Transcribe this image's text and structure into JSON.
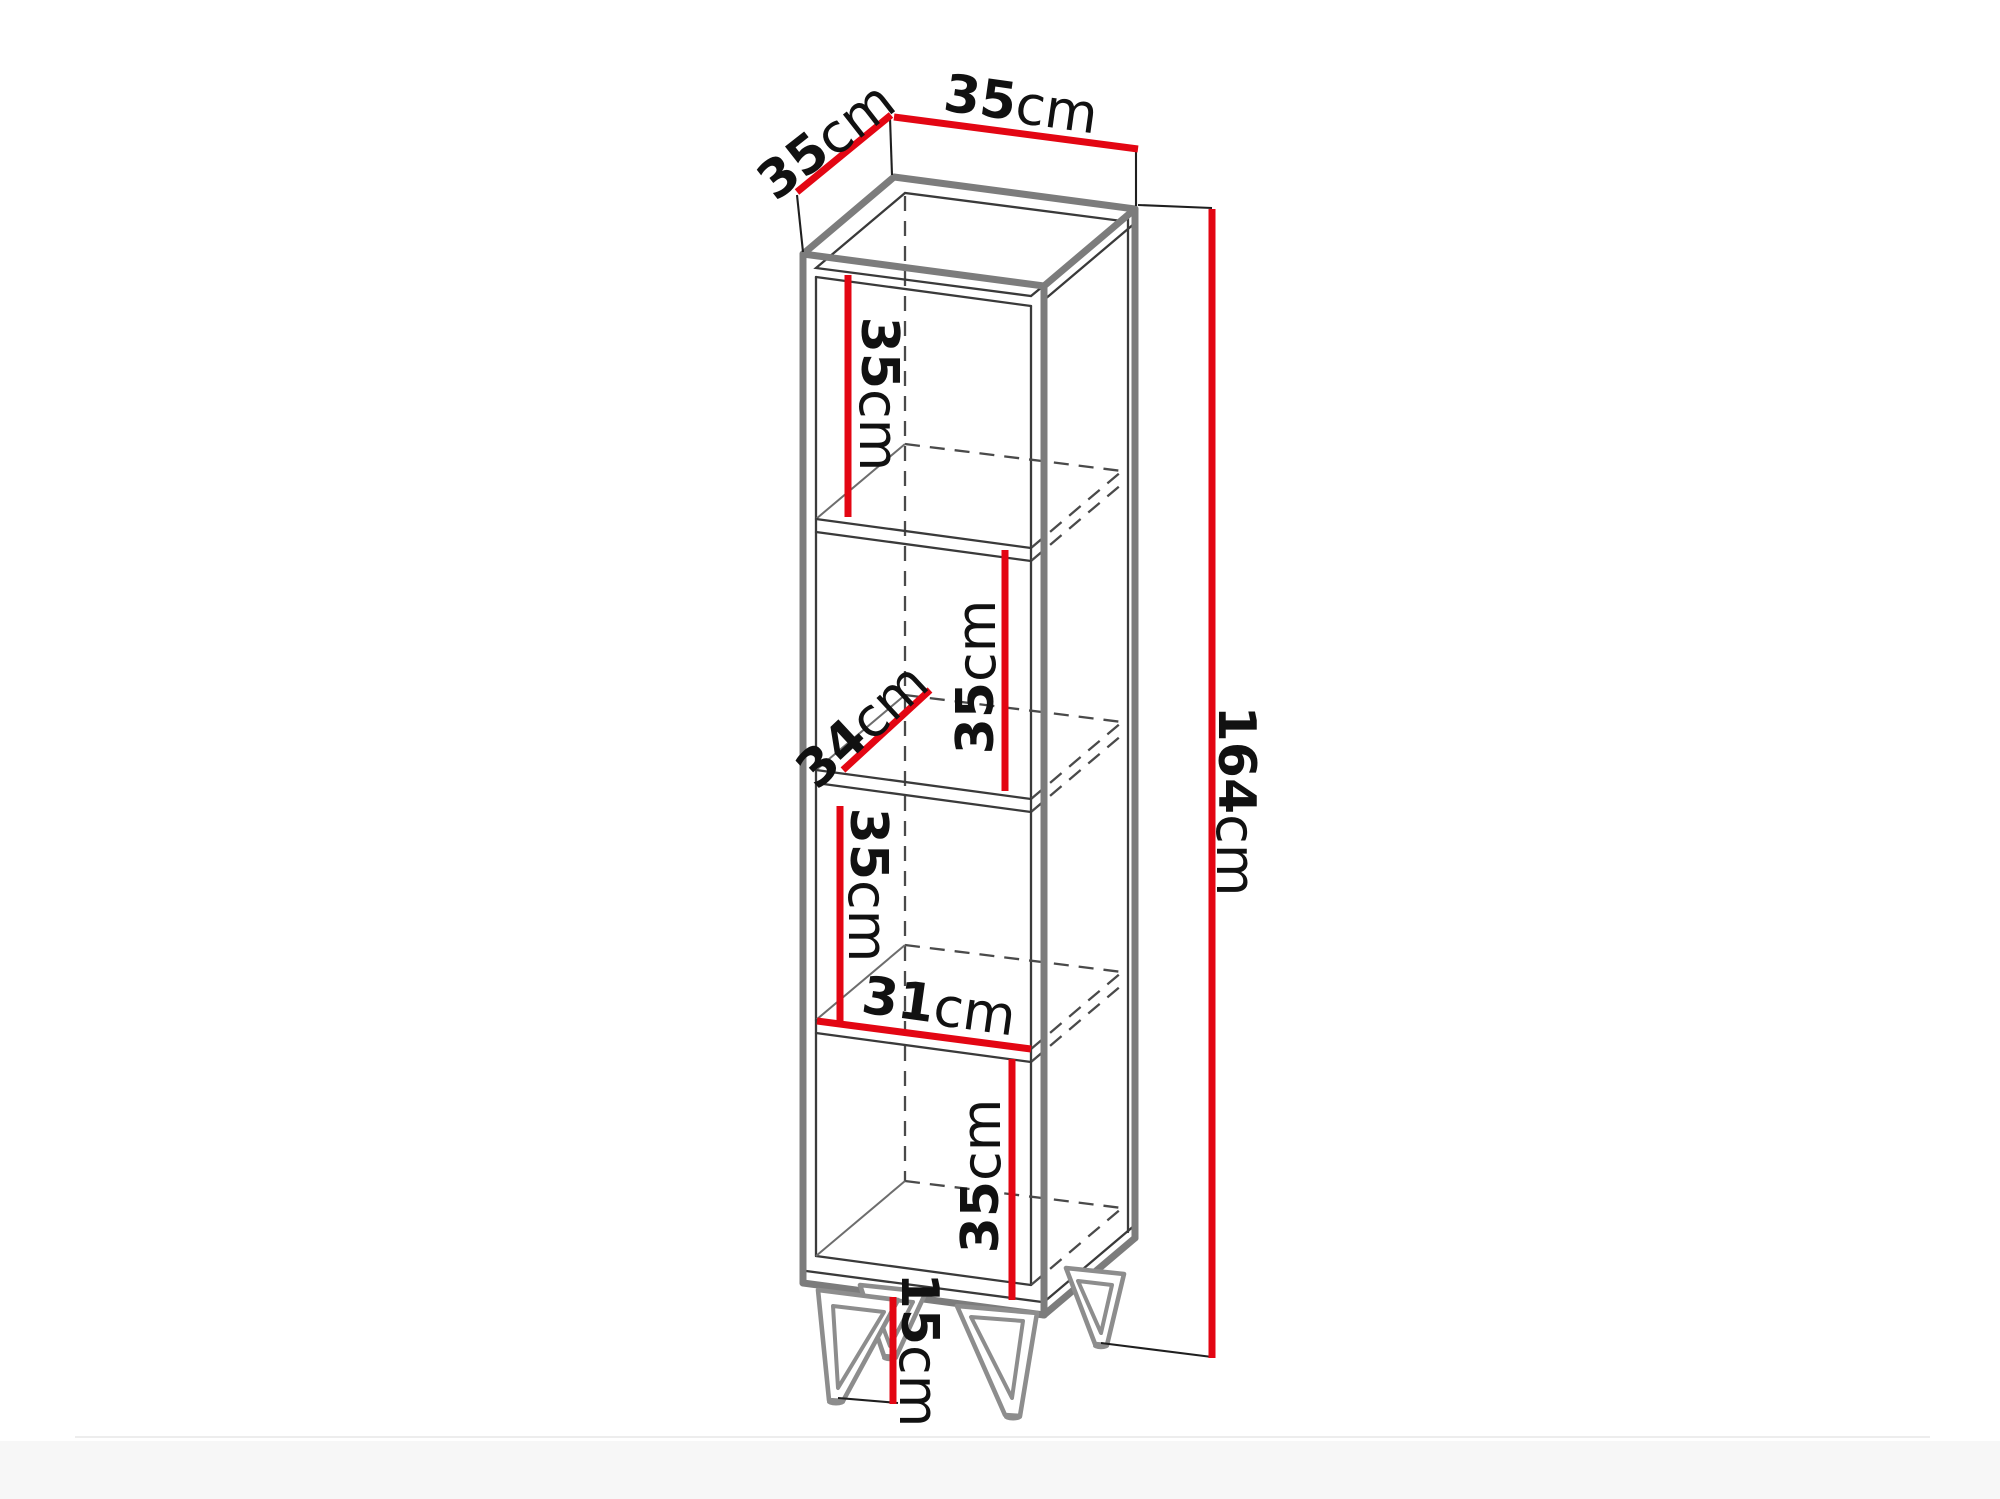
{
  "diagram": {
    "kind": "isometric furniture dimension drawing",
    "figure": "tall open shelf cabinet with four compartments on four hairpin legs",
    "unit_default": "cm",
    "colors": {
      "dimension_red": "#e30613",
      "outline_gray": "#7c7c7c",
      "line_dark": "#3a3a3a",
      "leg_gray": "#8d8d8d",
      "text": "#111111",
      "background": "#ffffff"
    },
    "dimensions": {
      "top_depth": {
        "value": "35",
        "unit": "cm"
      },
      "top_width": {
        "value": "35",
        "unit": "cm"
      },
      "compartment_1_height": {
        "value": "35",
        "unit": "cm"
      },
      "compartment_2_height": {
        "value": "35",
        "unit": "cm"
      },
      "interior_depth": {
        "value": "34",
        "unit": "cm"
      },
      "compartment_3_height": {
        "value": "35",
        "unit": "cm"
      },
      "interior_width": {
        "value": "31",
        "unit": "cm"
      },
      "compartment_4_height": {
        "value": "35",
        "unit": "cm"
      },
      "total_height": {
        "value": "164",
        "unit": "cm"
      },
      "leg_height": {
        "value": "15",
        "unit": "cm"
      }
    }
  }
}
